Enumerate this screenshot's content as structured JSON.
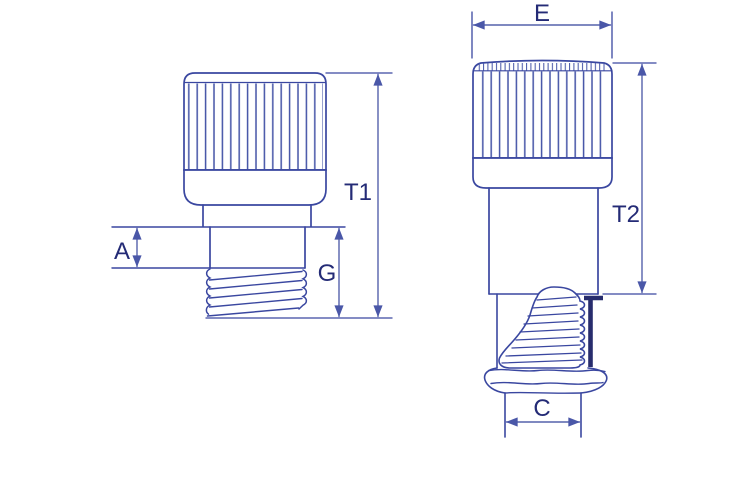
{
  "labels": {
    "t1": "T1",
    "a": "A",
    "g": "G",
    "e": "E",
    "t2": "T2",
    "c": "C"
  },
  "colors": {
    "outline": "#3a47a0",
    "knurl": "#4353a6",
    "dimension": "#5562ac",
    "label": "#242b76",
    "section_line": "#272c6d",
    "background": "#ffffff"
  }
}
